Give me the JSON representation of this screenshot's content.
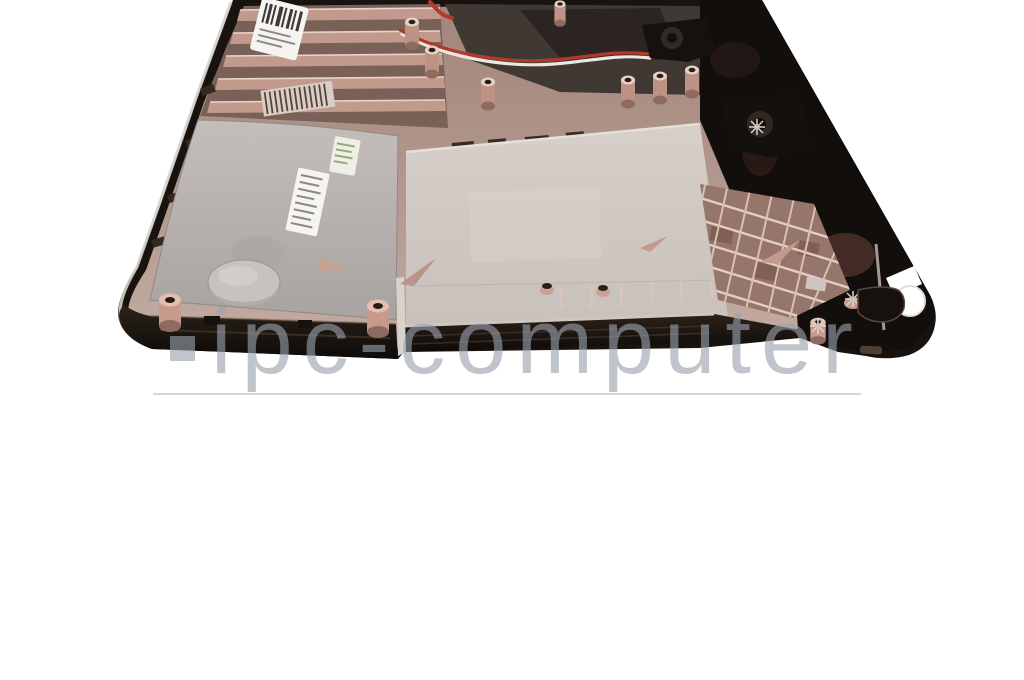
{
  "watermark": {
    "logo_icon": "square",
    "text": "ipc-computer"
  },
  "photo": {
    "subject_icon": "laptop-bottom-case"
  },
  "theme": {
    "background": "#ffffff",
    "case_dark": "#18130f",
    "case_black": "#110e0c",
    "case_rim": "#221a15",
    "deck_bronze": "#ae9188",
    "panel_silver": "#b6b1ae",
    "panel_beige": "#d1c9c3",
    "lattice_pink": "#96756a",
    "copper_light": "#e6cfc5",
    "copper_dark": "#8a665c",
    "wire_red": "#b23a2d",
    "wire_white": "#ece7e2",
    "label_white": "#f5f4f1",
    "chamfer_light": "#d6d0cb",
    "watermark_gray_rgba": "rgba(154,161,173,0.62)",
    "divider_gray": "#d6d6d6"
  }
}
